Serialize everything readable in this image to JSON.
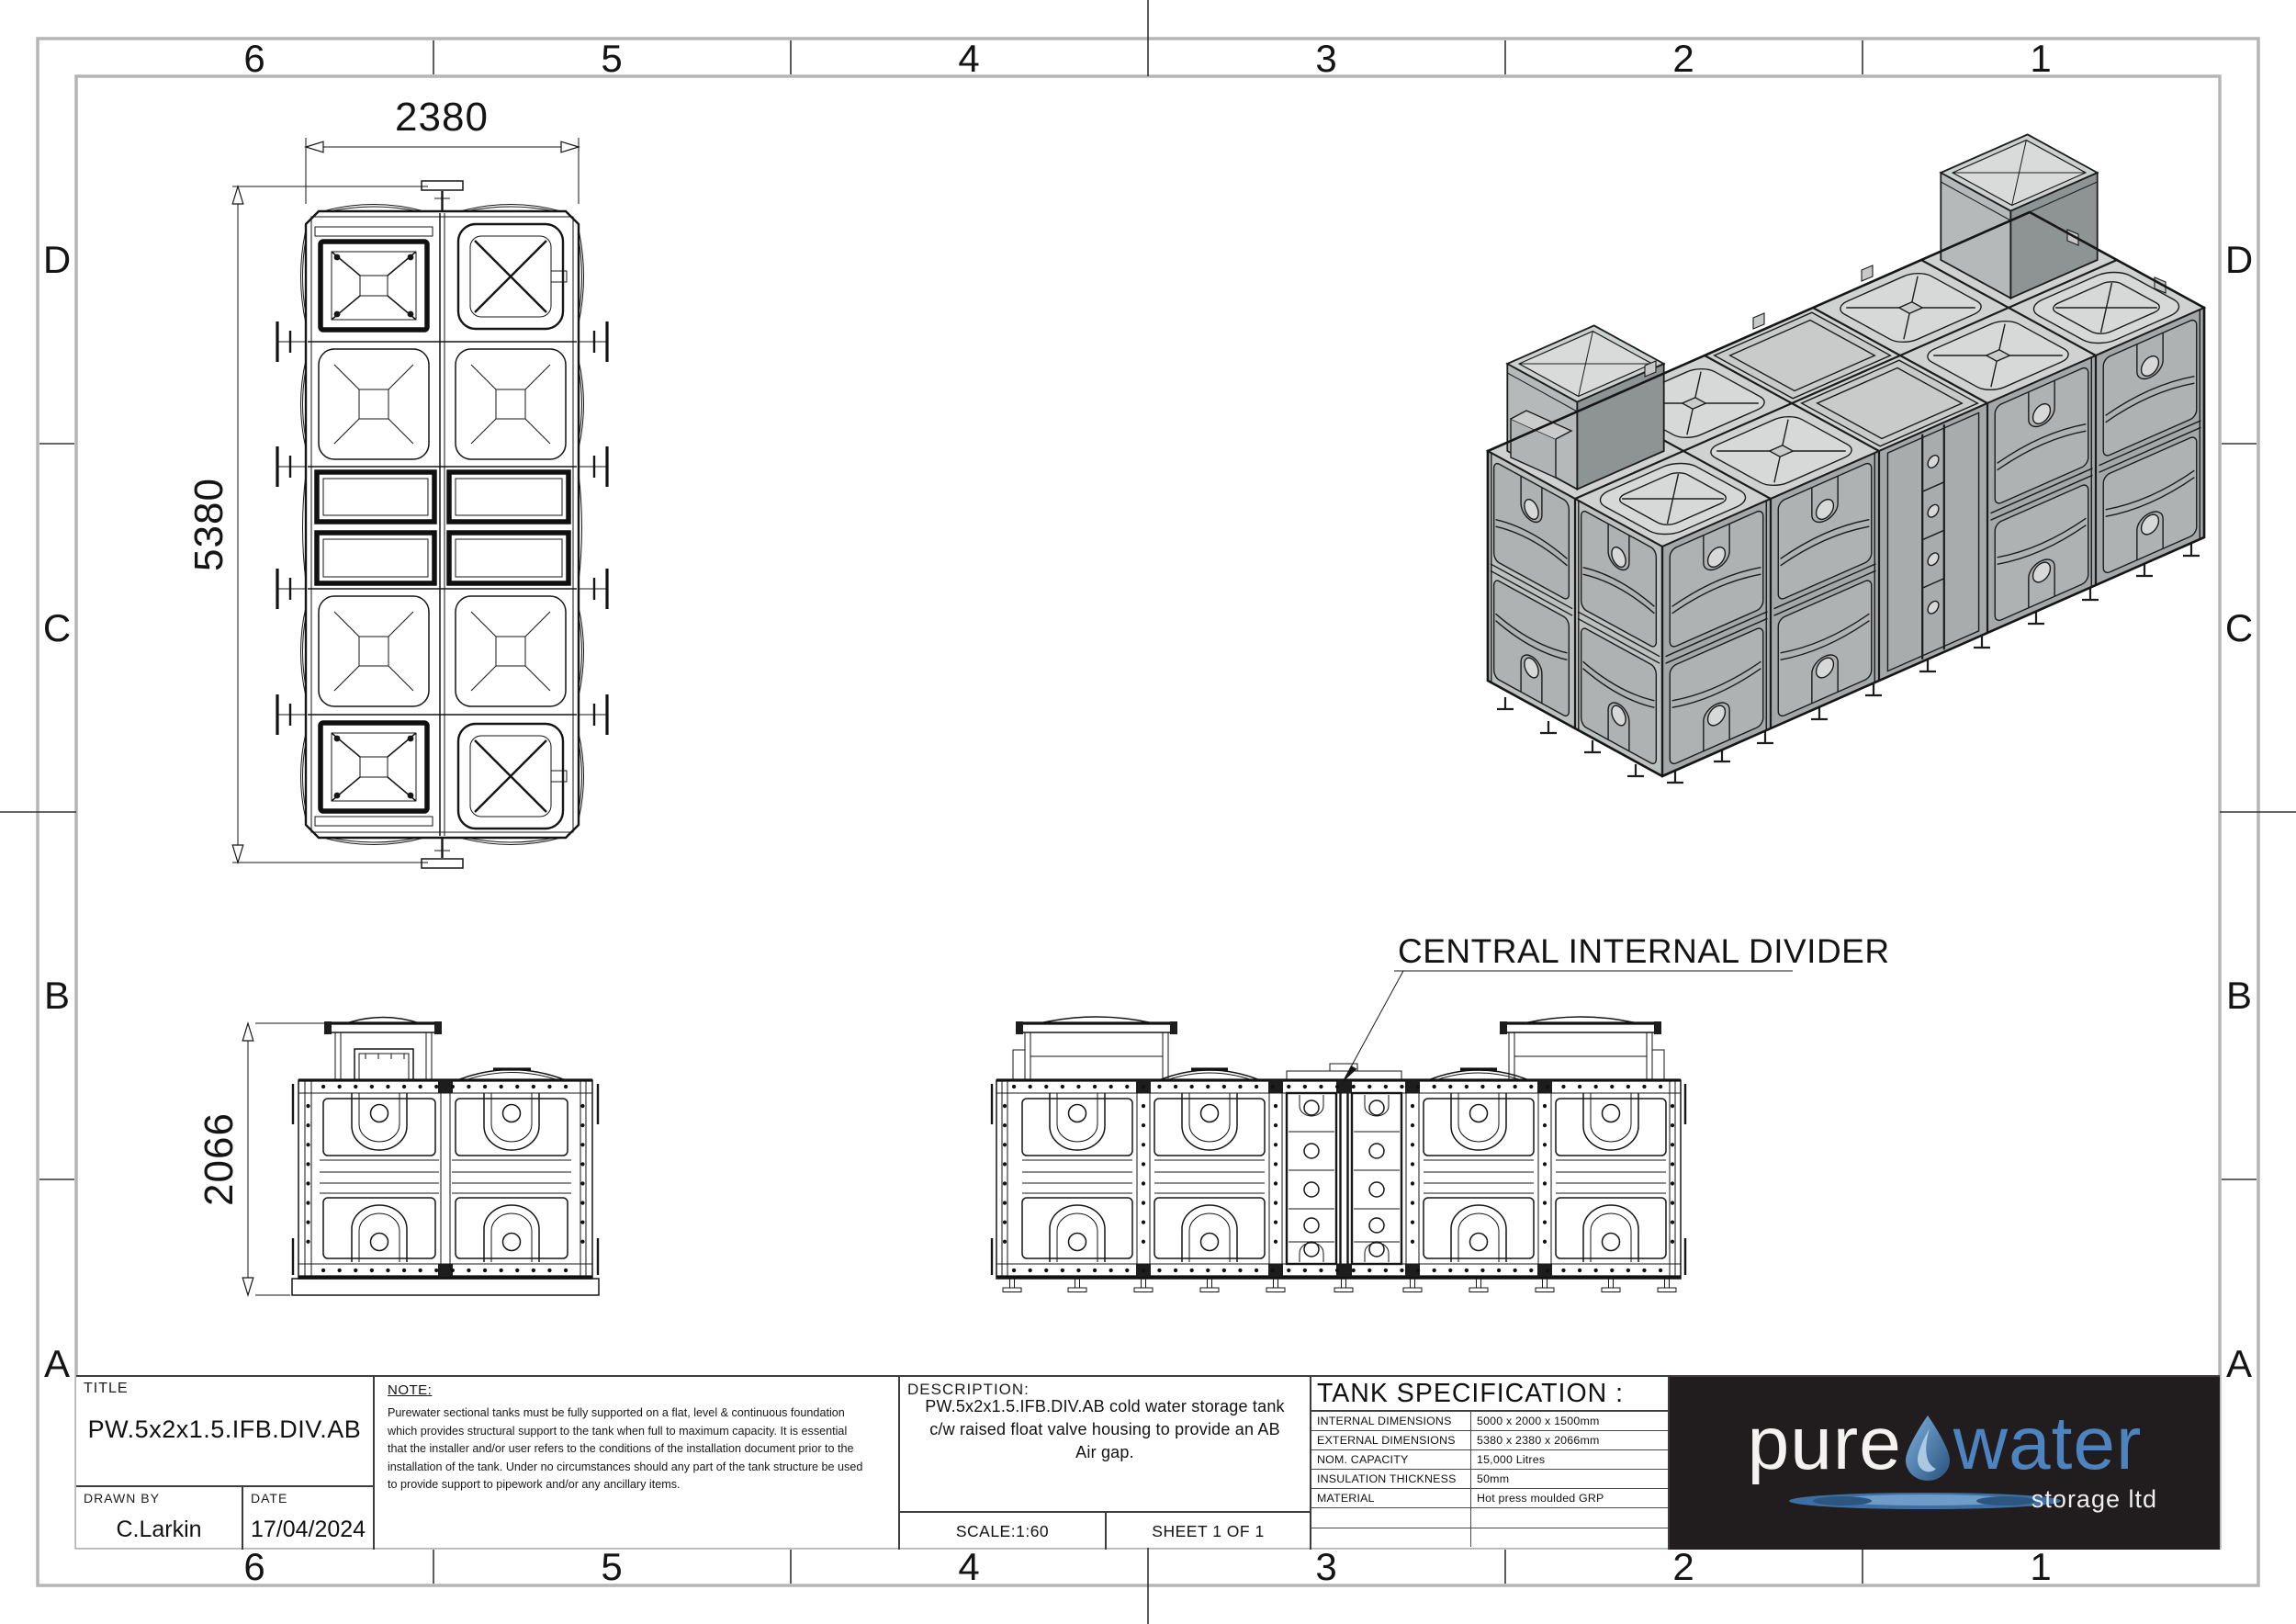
{
  "sheet": {
    "grid_cols": [
      "6",
      "5",
      "4",
      "3",
      "2",
      "1"
    ],
    "grid_rows": [
      "D",
      "C",
      "B",
      "A"
    ]
  },
  "plan_view": {
    "width_dim": "2380",
    "length_dim": "5380"
  },
  "side_view": {
    "height_dim": "2066"
  },
  "front_view": {
    "annotation": "CENTRAL INTERNAL DIVIDER"
  },
  "title_block": {
    "title_label": "TITLE",
    "title": "PW.5x2x1.5.IFB.DIV.AB",
    "drawn_by_label": "DRAWN BY",
    "drawn_by": "C.Larkin",
    "date_label": "DATE",
    "date": "17/04/2024",
    "note_label": "NOTE:",
    "note_lines": [
      "Purewater sectional tanks must be fully supported on a flat, level & continuous foundation",
      "which provides structural support to the tank when full to maximum capacity. It is essential",
      "that the installer and/or user refers to the conditions of the installation document prior to the",
      "installation of the tank. Under no circumstances should any part of the tank structure be used",
      "to provide support to pipework and/or any ancillary items."
    ],
    "description_label": "DESCRIPTION:",
    "description_lines": [
      "PW.5x2x1.5.IFB.DIV.AB cold water storage tank",
      "c/w raised float valve housing to provide an AB",
      "Air gap."
    ],
    "scale": "SCALE:1:60",
    "sheet": "SHEET 1 OF 1"
  },
  "tank_specification": {
    "heading": "TANK SPECIFICATION :",
    "rows": [
      {
        "label": "INTERNAL DIMENSIONS",
        "value": "5000 x 2000 x 1500mm"
      },
      {
        "label": "EXTERNAL DIMENSIONS",
        "value": "5380 x 2380 x 2066mm"
      },
      {
        "label": "NOM. CAPACITY",
        "value": "15,000 Litres"
      },
      {
        "label": "INSULATION THICKNESS",
        "value": "50mm"
      },
      {
        "label": "MATERIAL",
        "value": "Hot press moulded GRP"
      },
      {
        "label": "",
        "value": ""
      },
      {
        "label": "",
        "value": ""
      }
    ]
  },
  "logo": {
    "word1": "pure",
    "word2": "water",
    "word3": "storage ltd"
  },
  "colors": {
    "line": "#151515",
    "frame_gray": "#b5b5b5",
    "logo_bg": "#211d1e",
    "logo_blue": "#4d84bf"
  }
}
